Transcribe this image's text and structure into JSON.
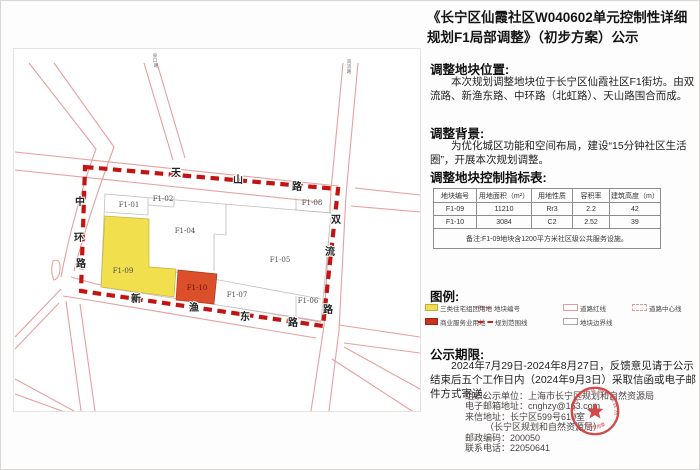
{
  "title": "《长宁区仙霞社区W040602单元控制性详细规划F1局部调整》（初步方案）公示",
  "sections": {
    "location": {
      "heading": "调整地块位置:",
      "body": "本次规划调整地块位于长宁区仙霞社区F1街坊。由双流路、新渔东路、中环路（北虹路）、天山路围合而成。"
    },
    "background": {
      "heading": "调整背景:",
      "body": "为优化城区功能和空间布局，建设“15分钟社区生活圈”，开展本次规划调整。"
    },
    "indicator_table": {
      "heading": "调整地块控制指标表:",
      "headers": [
        "地块编号",
        "用地面积（m²）",
        "用地性质",
        "容积率",
        "建筑高度（m）"
      ],
      "rows": [
        [
          "F1-09",
          "11210",
          "Rr3",
          "2.2",
          "42"
        ],
        [
          "F1-10",
          "3084",
          "C2",
          "2.52",
          "39"
        ]
      ],
      "note": "备注:F1-09地块含1200平方米社区级公共服务设施。"
    },
    "legend": {
      "heading": "图例:",
      "items": [
        {
          "label": "三类住宅组团用地"
        },
        {
          "label": "地块编号",
          "sample": "F1-xx"
        },
        {
          "label": "道路红线"
        },
        {
          "label": "道路中心线"
        },
        {
          "label": "商业服务业用地"
        },
        {
          "label": "规划范围线"
        },
        {
          "label": "地块边界线"
        }
      ]
    },
    "period": {
      "heading": "公示期限:",
      "body": "2024年7月29日-2024年8月27日，反馈意见请于公示结束后五个工作日内（2024年9月3日）采取信函或电子邮件方式寄送。"
    }
  },
  "contact": {
    "organizer": "组织公示单位：上海市长宁区规划和自然资源局",
    "email": "电子邮箱地址：cnghzy@163.com",
    "address": "来信地址：长宁区599号610室",
    "address2": "（长宁区规划和自然资源局）",
    "postcode": "邮政编码：200050",
    "phone": "联系电话：22050641"
  },
  "stamp": {
    "ring_text": "上海市长宁区规划和自然资源局",
    "bottom_text": "公示专用章"
  },
  "map": {
    "parcels": {
      "p01": "F1-01",
      "p02": "F1-02",
      "p04": "F1-04",
      "p05": "F1-05",
      "p06": "F1-06",
      "p07": "F1-07",
      "p08": "F1-08",
      "p09": "F1-09",
      "p10": "F1-10"
    },
    "roads": {
      "tianshan": [
        "天",
        "山",
        "路"
      ],
      "zhonghuan": [
        "中",
        "环",
        "路"
      ],
      "shuangliu": [
        "双",
        "流",
        "路"
      ],
      "xinyudong": [
        "新",
        "渔",
        "东",
        "路"
      ],
      "small_left": [
        "泉",
        "口",
        "路"
      ],
      "small_right": [
        "双",
        "流",
        "路"
      ]
    }
  },
  "colors": {
    "residential_yellow": "#f2df4e",
    "commercial_red": "#dc4f2b",
    "boundary_red": "#c21414",
    "road_pink": "#e79f9f",
    "stamp_red": "#cf3b3b"
  }
}
